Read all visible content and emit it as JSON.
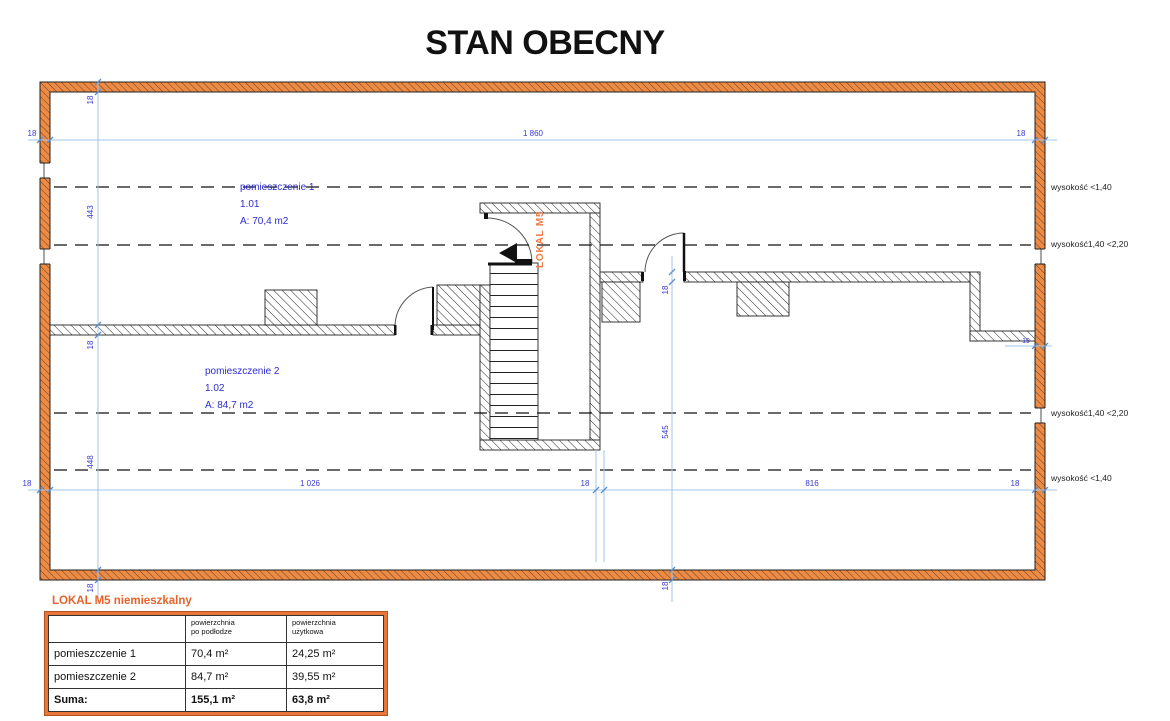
{
  "title": "STAN OBECNY",
  "colors": {
    "wall_orange": "#ef8a43",
    "accent_orange": "#e8632a",
    "dim_line_blue": "#a3c6e8",
    "dim_text_blue": "#3a3ace",
    "room_label_blue": "#2b2bd0"
  },
  "plan": {
    "unit_label": "LOKAL M5",
    "rooms": [
      {
        "name": "pomieszczenie 1",
        "number": "1.01",
        "area": "A: 70,4 m2"
      },
      {
        "name": "pomieszczenie 2",
        "number": "1.02",
        "area": "A: 84,7 m2"
      }
    ],
    "height_labels": [
      "wysokość <1,40",
      "wysokość1,40 <2,20",
      "wysokość1,40 <2,20",
      "wysokość <1,40"
    ],
    "dims": {
      "top_total": "1 860",
      "top_wall_left": "18",
      "top_wall_right": "18",
      "bottom_seg1": "1 026",
      "bottom_mid_wall": "18",
      "bottom_seg2": "816",
      "bottom_left_wall": "18",
      "bottom_right_wall": "18",
      "left_v1": "18",
      "left_v2": "443",
      "left_v3": "18",
      "left_v4": "448",
      "left_v5": "18",
      "mid_v1": "18",
      "mid_v2": "545",
      "mid_v3": "18",
      "right_step": "19"
    }
  },
  "legend": {
    "title": "LOKAL M5 niemieszkalny",
    "table": {
      "col_headers": [
        "powierzchnia\npo podłodze",
        "powierzchnia\nużytkowa"
      ],
      "rows": [
        {
          "label": "pomieszczenie 1",
          "floor": "70,4 m²",
          "usable": "24,25 m²"
        },
        {
          "label": "pomieszczenie 2",
          "floor": "84,7 m²",
          "usable": "39,55 m²"
        },
        {
          "label": "Suma:",
          "floor": "155,1 m²",
          "usable": "63,8 m²"
        }
      ]
    }
  }
}
